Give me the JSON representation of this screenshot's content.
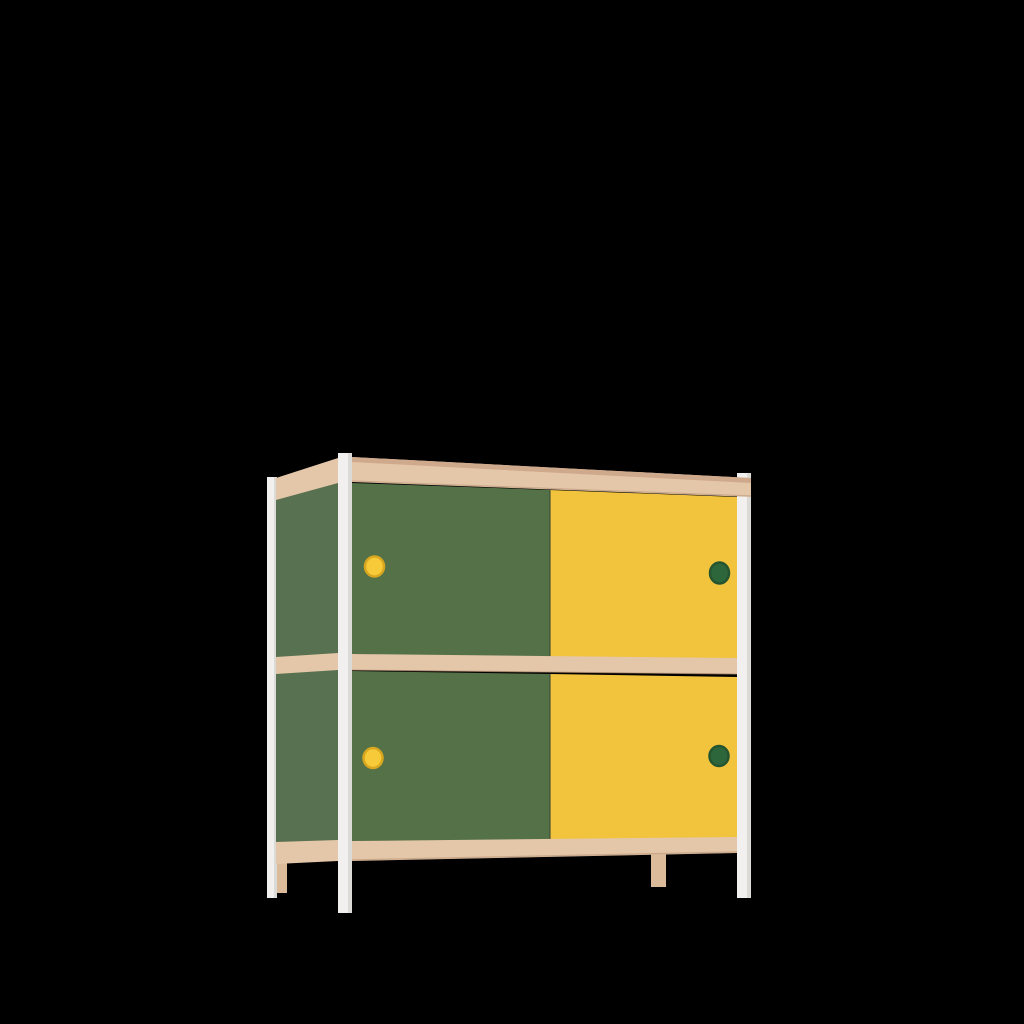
{
  "scene": {
    "background": "#000000",
    "subject": "Two-tier kids cabinet with green and yellow sliding doors, beech wood rails and white frame legs, rendered on a black background"
  },
  "cabinet": {
    "rows": 2,
    "doors_per_row": 2,
    "doors": [
      {
        "position": "top-left",
        "door_color": "green",
        "handle_color": "yellow"
      },
      {
        "position": "top-right",
        "door_color": "yellow",
        "handle_color": "green"
      },
      {
        "position": "bottom-left",
        "door_color": "green",
        "handle_color": "yellow"
      },
      {
        "position": "bottom-right",
        "door_color": "yellow",
        "handle_color": "green"
      }
    ],
    "colors": {
      "wood": "#e4c6a9",
      "wood_top_edge": "#cfa98c",
      "wood_bottom_edge": "#bb9678",
      "wood_leg": "#dcbb9b",
      "door_green": "#547147",
      "side_green": "#587150",
      "door_yellow": "#f2c33c",
      "leg_white": "#f1f0ee",
      "leg_shade": "#dcdad6",
      "handle_yellow": "#f6ca39",
      "handle_yellow_rim": "#d9a71f",
      "handle_green": "#2e663c",
      "handle_green_rim": "#255430",
      "door_seam": "#3d4a38"
    }
  }
}
